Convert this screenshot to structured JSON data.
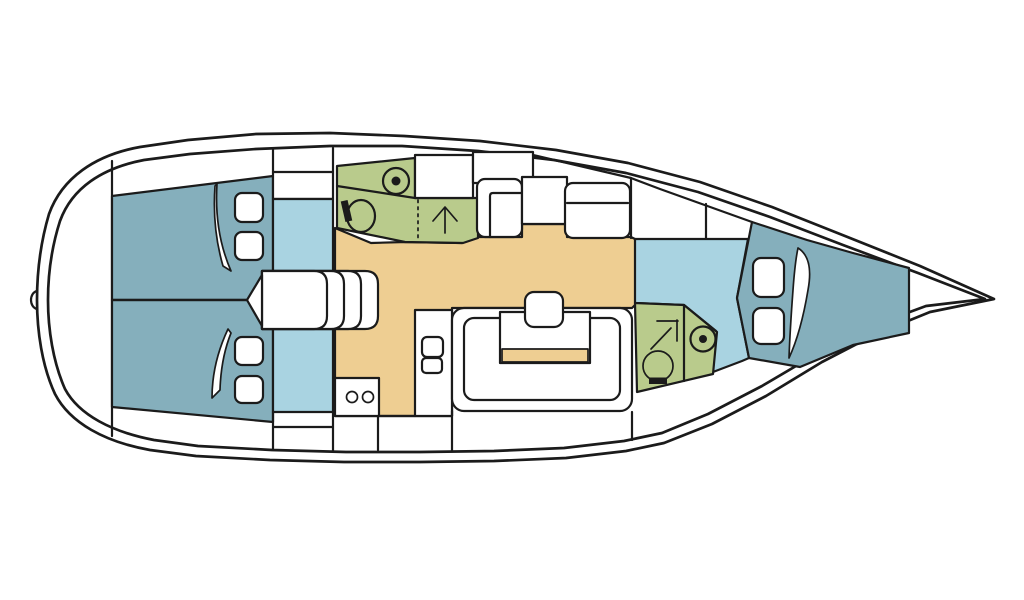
{
  "diagram": {
    "type": "sailboat-interior-floor-plan",
    "orientation": "bow-right",
    "colors": {
      "ink": "#1b1b1b",
      "cabin": "#85AFBC",
      "passage": "#A9D3E1",
      "wet_room": "#B9CB8C",
      "floor": "#EECE92",
      "background": "#ffffff"
    },
    "rooms": {
      "aft_cabin_port": "aft double berth cabin (top)",
      "aft_cabin_starboard": "aft double berth cabin (bottom)",
      "aft_head": "aft head with shower, sink and toilet",
      "galley": "galley with stove and twin sinks",
      "salon": "salon with U-settee, table and stool",
      "dinette_settees": "starboard settees with side table",
      "forward_head": "forward head with shower, sink and toilet",
      "forward_cabin": "forward V-berth cabin",
      "companionway": "companionway steps",
      "passageways": "cabin access passages"
    },
    "fixtures": {
      "toilet_count": 2,
      "sink_count": 2,
      "shower_count": 2,
      "berth_count": 3,
      "stove_burners": 2,
      "galley_sinks": 2
    }
  }
}
